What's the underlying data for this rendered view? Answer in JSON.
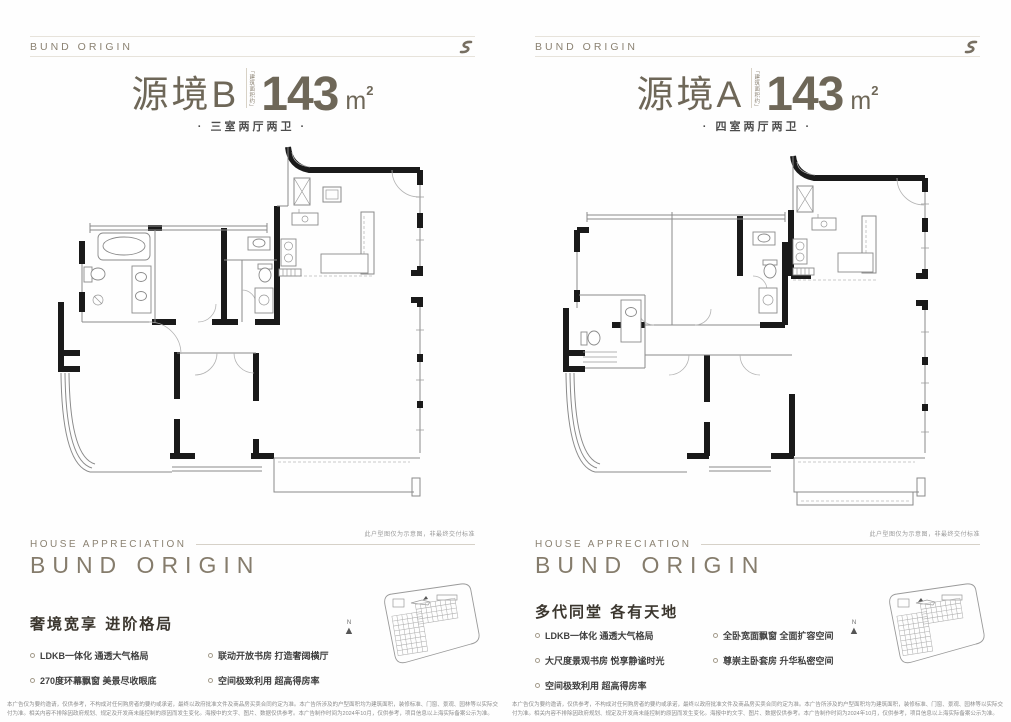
{
  "colors": {
    "brand": "#8b8272",
    "title": "#6e6758",
    "headline": "#3b362e",
    "body_text": "#3f3f3f",
    "wall": "#1a1a1a",
    "rule": "#e7e3db"
  },
  "panels": [
    {
      "brand": "BUND ORIGIN",
      "unit_name": "源境B",
      "area_prefix_vertical": "「建筑面积约」",
      "area_value": "143",
      "area_unit": "m",
      "area_exponent": "2",
      "layout_tag": "· 三室两厅两卫 ·",
      "plan_note": "此户型图仅为示意图，非最终交付标准",
      "footer_eyebrow": "HOUSE APPRECIATION",
      "footer_brand": "BUND ORIGIN",
      "headline": "奢境宽享 进阶格局",
      "bullets": [
        "LDKB一体化 通透大气格局",
        "联动开放书房 打造奢阔横厅",
        "270度环幕飘窗 美景尽收眼底",
        "空间极致利用 超高得房率"
      ],
      "compass_label": "N",
      "disclaimer": "本广告仅为要约邀请，仅供参考，不构成对任何购房者的要约或承诺，最终以政府批准文件及商品房买卖合同约定为准。本广告所涉及的户型面积均为建筑面积，装修标准、门窗、景观、园林等以实际交付为准。相关内容不排除因政府规划、规定及开发商未能控制的原因而发生变化。海报中的文字、图片、数据仅供参考。本广告制作时间为2024年10月，仅供参考，项目信息以上海实际备案公示为准。"
    },
    {
      "brand": "BUND ORIGIN",
      "unit_name": "源境A",
      "area_prefix_vertical": "「建筑面积约」",
      "area_value": "143",
      "area_unit": "m",
      "area_exponent": "2",
      "layout_tag": "· 四室两厅两卫 ·",
      "plan_note": "此户型图仅为示意图，非最终交付标准",
      "footer_eyebrow": "HOUSE APPRECIATION",
      "footer_brand": "BUND ORIGIN",
      "headline": "多代同堂 各有天地",
      "bullets": [
        "LDKB一体化 通透大气格局",
        "全卧宽面飘窗 全面扩容空间",
        "大尺度景观书房 悦享静谧时光",
        "尊崇主卧套房 升华私密空间",
        "空间极致利用 超高得房率"
      ],
      "compass_label": "N",
      "disclaimer": "本广告仅为要约邀请，仅供参考，不构成对任何购房者的要约或承诺，最终以政府批准文件及商品房买卖合同约定为准。本广告所涉及的户型面积均为建筑面积，装修标准、门窗、景观、园林等以实际交付为准。相关内容不排除因政府规划、规定及开发商未能控制的原因而发生变化。海报中的文字、图片、数据仅供参考。本广告制作时间为2024年10月，仅供参考，项目信息以上海实际备案公示为准。"
    }
  ]
}
